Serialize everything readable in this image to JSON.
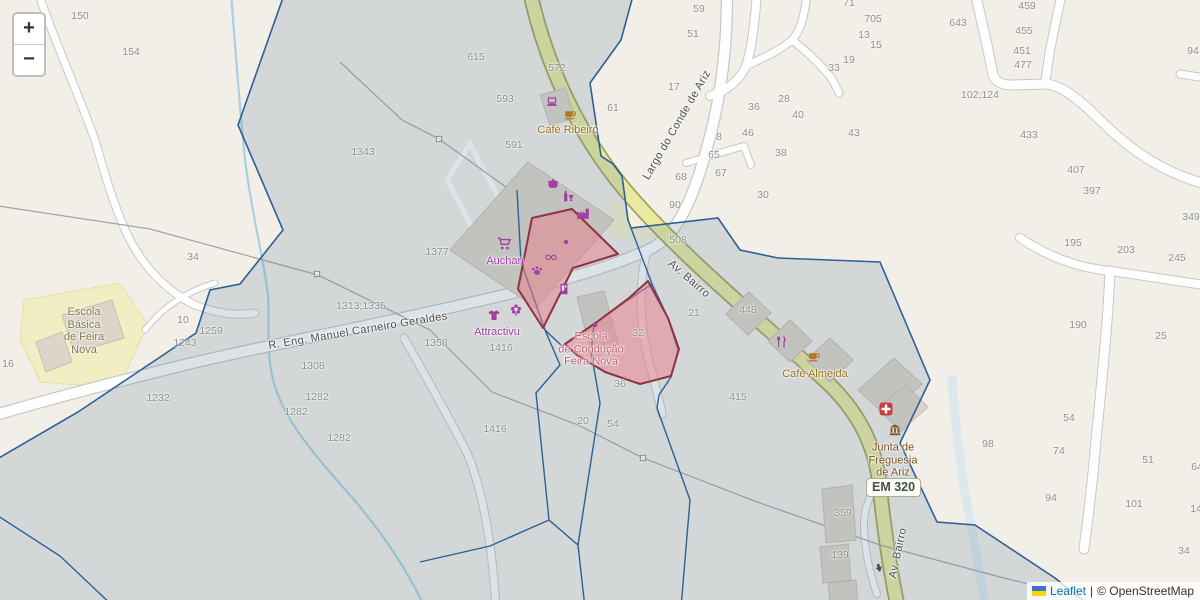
{
  "map": {
    "controls": {
      "zoom_in": "+",
      "zoom_out": "−"
    },
    "em_shield": "EM 320",
    "attribution": {
      "leaflet": "Leaflet",
      "separator": "|",
      "osm": "© OpenStreetMap"
    },
    "colors": {
      "boundary_blue": "#2e6094",
      "road_yellow": "#e9e9a0",
      "polygon_pink_fill": "#eb7d8a",
      "polygon_pink_border": "#8e3344",
      "shop_purple": "#a23ba2",
      "cafe_brown": "#9c6f14",
      "civic_brown": "#7a5224",
      "school_olive": "#7d7d4a",
      "driving_pink": "#c25e72",
      "link_blue": "#0078a8",
      "housenumber_gray": "#8e8e8e",
      "land_cream": "#f2efe9"
    },
    "street_labels": [
      {
        "text": "R. Eng. Manuel Carneiro Geraldes",
        "x": 358,
        "y": 331,
        "rot": -9.5
      },
      {
        "text": "Largo do Conde de Ariz",
        "x": 677,
        "y": 125,
        "rot": -60
      },
      {
        "text": "Av. Bairro",
        "x": 689,
        "y": 279,
        "rot": 41
      },
      {
        "text": "Av. Bairro",
        "x": 898,
        "y": 553,
        "rot": -78
      }
    ],
    "poi_labels": [
      {
        "lines": [
          "Café Ribeiro"
        ],
        "x": 568,
        "y": 130,
        "color": "cafe"
      },
      {
        "lines": [
          "Auchan"
        ],
        "x": 505,
        "y": 261,
        "color": "shop"
      },
      {
        "lines": [
          "Attractivu"
        ],
        "x": 497,
        "y": 332,
        "color": "shop"
      },
      {
        "lines": [
          "Escola",
          "de Condução",
          "Feira Nova"
        ],
        "x": 591,
        "y": 349,
        "color": "driving"
      },
      {
        "lines": [
          "Café Almeida"
        ],
        "x": 815,
        "y": 374,
        "color": "cafe"
      },
      {
        "lines": [
          "Junta de",
          "Freguesia",
          "de Ariz"
        ],
        "x": 893,
        "y": 460,
        "color": "civic"
      },
      {
        "lines": [
          "Escola",
          "Básica",
          "de Feira",
          "Nova"
        ],
        "x": 84,
        "y": 331,
        "color": "school"
      }
    ],
    "house_numbers": [
      {
        "t": "150",
        "x": 80,
        "y": 16
      },
      {
        "t": "154",
        "x": 131,
        "y": 52
      },
      {
        "t": "1343",
        "x": 363,
        "y": 152
      },
      {
        "t": "34",
        "x": 193,
        "y": 257
      },
      {
        "t": "615",
        "x": 476,
        "y": 57
      },
      {
        "t": "572",
        "x": 557,
        "y": 68
      },
      {
        "t": "593",
        "x": 505,
        "y": 99
      },
      {
        "t": "591",
        "x": 514,
        "y": 145
      },
      {
        "t": "61",
        "x": 613,
        "y": 108
      },
      {
        "t": "17",
        "x": 674,
        "y": 87
      },
      {
        "t": "59",
        "x": 699,
        "y": 9
      },
      {
        "t": "51",
        "x": 693,
        "y": 34
      },
      {
        "t": "71",
        "x": 849,
        "y": 3
      },
      {
        "t": "705",
        "x": 873,
        "y": 19
      },
      {
        "t": "13",
        "x": 864,
        "y": 35
      },
      {
        "t": "15",
        "x": 876,
        "y": 45
      },
      {
        "t": "19",
        "x": 849,
        "y": 60
      },
      {
        "t": "33",
        "x": 834,
        "y": 68
      },
      {
        "t": "28",
        "x": 784,
        "y": 99
      },
      {
        "t": "36",
        "x": 754,
        "y": 107
      },
      {
        "t": "40",
        "x": 798,
        "y": 115
      },
      {
        "t": "46",
        "x": 748,
        "y": 133
      },
      {
        "t": "8",
        "x": 719,
        "y": 137
      },
      {
        "t": "65",
        "x": 714,
        "y": 155
      },
      {
        "t": "38",
        "x": 781,
        "y": 153
      },
      {
        "t": "67",
        "x": 721,
        "y": 173
      },
      {
        "t": "68",
        "x": 681,
        "y": 177
      },
      {
        "t": "30",
        "x": 763,
        "y": 195
      },
      {
        "t": "90",
        "x": 675,
        "y": 205
      },
      {
        "t": "43",
        "x": 854,
        "y": 133
      },
      {
        "t": "643",
        "x": 958,
        "y": 23
      },
      {
        "t": "459",
        "x": 1027,
        "y": 6
      },
      {
        "t": "455",
        "x": 1024,
        "y": 31
      },
      {
        "t": "451",
        "x": 1022,
        "y": 51
      },
      {
        "t": "477",
        "x": 1023,
        "y": 65
      },
      {
        "t": "102;124",
        "x": 980,
        "y": 95
      },
      {
        "t": "433",
        "x": 1029,
        "y": 135
      },
      {
        "t": "94",
        "x": 1193,
        "y": 51
      },
      {
        "t": "407",
        "x": 1076,
        "y": 170
      },
      {
        "t": "397",
        "x": 1092,
        "y": 191
      },
      {
        "t": "349",
        "x": 1191,
        "y": 217
      },
      {
        "t": "195",
        "x": 1073,
        "y": 243
      },
      {
        "t": "203",
        "x": 1126,
        "y": 250
      },
      {
        "t": "245",
        "x": 1177,
        "y": 258
      },
      {
        "t": "190",
        "x": 1078,
        "y": 325
      },
      {
        "t": "25",
        "x": 1161,
        "y": 336
      },
      {
        "t": "508",
        "x": 678,
        "y": 240
      },
      {
        "t": "1377",
        "x": 437,
        "y": 252
      },
      {
        "t": "1313;1335",
        "x": 361,
        "y": 306
      },
      {
        "t": "10",
        "x": 183,
        "y": 320
      },
      {
        "t": "1259",
        "x": 211,
        "y": 331
      },
      {
        "t": "1243",
        "x": 185,
        "y": 343
      },
      {
        "t": "16",
        "x": 8,
        "y": 364
      },
      {
        "t": "1232",
        "x": 158,
        "y": 398
      },
      {
        "t": "1308",
        "x": 313,
        "y": 366
      },
      {
        "t": "1282",
        "x": 317,
        "y": 397
      },
      {
        "t": "1282",
        "x": 296,
        "y": 412
      },
      {
        "t": "1282",
        "x": 339,
        "y": 438
      },
      {
        "t": "1358",
        "x": 436,
        "y": 343
      },
      {
        "t": "1416",
        "x": 501,
        "y": 348
      },
      {
        "t": "1416",
        "x": 495,
        "y": 429
      },
      {
        "t": "20",
        "x": 583,
        "y": 421
      },
      {
        "t": "54",
        "x": 613,
        "y": 424
      },
      {
        "t": "36",
        "x": 620,
        "y": 384
      },
      {
        "t": "32",
        "x": 638,
        "y": 333
      },
      {
        "t": "21",
        "x": 694,
        "y": 313
      },
      {
        "t": "448",
        "x": 748,
        "y": 310
      },
      {
        "t": "415",
        "x": 738,
        "y": 397
      },
      {
        "t": "359",
        "x": 843,
        "y": 513
      },
      {
        "t": "139",
        "x": 840,
        "y": 555
      },
      {
        "t": "98",
        "x": 988,
        "y": 444
      },
      {
        "t": "54",
        "x": 1069,
        "y": 418
      },
      {
        "t": "74",
        "x": 1059,
        "y": 451
      },
      {
        "t": "94",
        "x": 1051,
        "y": 498
      },
      {
        "t": "51",
        "x": 1148,
        "y": 460
      },
      {
        "t": "101",
        "x": 1134,
        "y": 504
      },
      {
        "t": "34",
        "x": 1184,
        "y": 551
      },
      {
        "t": "64",
        "x": 1197,
        "y": 467
      },
      {
        "t": "141",
        "x": 1199,
        "y": 509
      }
    ],
    "icons": [
      {
        "type": "laptop",
        "x": 552,
        "y": 102
      },
      {
        "type": "coffee",
        "x": 570,
        "y": 114
      },
      {
        "type": "pot",
        "x": 553,
        "y": 183
      },
      {
        "type": "drinks",
        "x": 568,
        "y": 196
      },
      {
        "type": "factory",
        "x": 583,
        "y": 213
      },
      {
        "type": "cart",
        "x": 504,
        "y": 243
      },
      {
        "type": "dot",
        "x": 566,
        "y": 242
      },
      {
        "type": "glasses",
        "x": 551,
        "y": 257
      },
      {
        "type": "paw",
        "x": 537,
        "y": 270
      },
      {
        "type": "vending",
        "x": 564,
        "y": 289
      },
      {
        "type": "tshirt",
        "x": 494,
        "y": 315
      },
      {
        "type": "flower",
        "x": 516,
        "y": 310
      },
      {
        "type": "dot",
        "x": 595,
        "y": 325
      },
      {
        "type": "cutlery",
        "x": 781,
        "y": 342
      },
      {
        "type": "coffee",
        "x": 814,
        "y": 356
      },
      {
        "type": "medical",
        "x": 886,
        "y": 409
      },
      {
        "type": "townhall",
        "x": 895,
        "y": 430
      },
      {
        "type": "pylon",
        "x": 317,
        "y": 274
      },
      {
        "type": "pylon",
        "x": 439,
        "y": 139
      },
      {
        "type": "pylon",
        "x": 643,
        "y": 458
      },
      {
        "type": "arrow",
        "x": 879,
        "y": 568,
        "rot": 165
      }
    ]
  }
}
